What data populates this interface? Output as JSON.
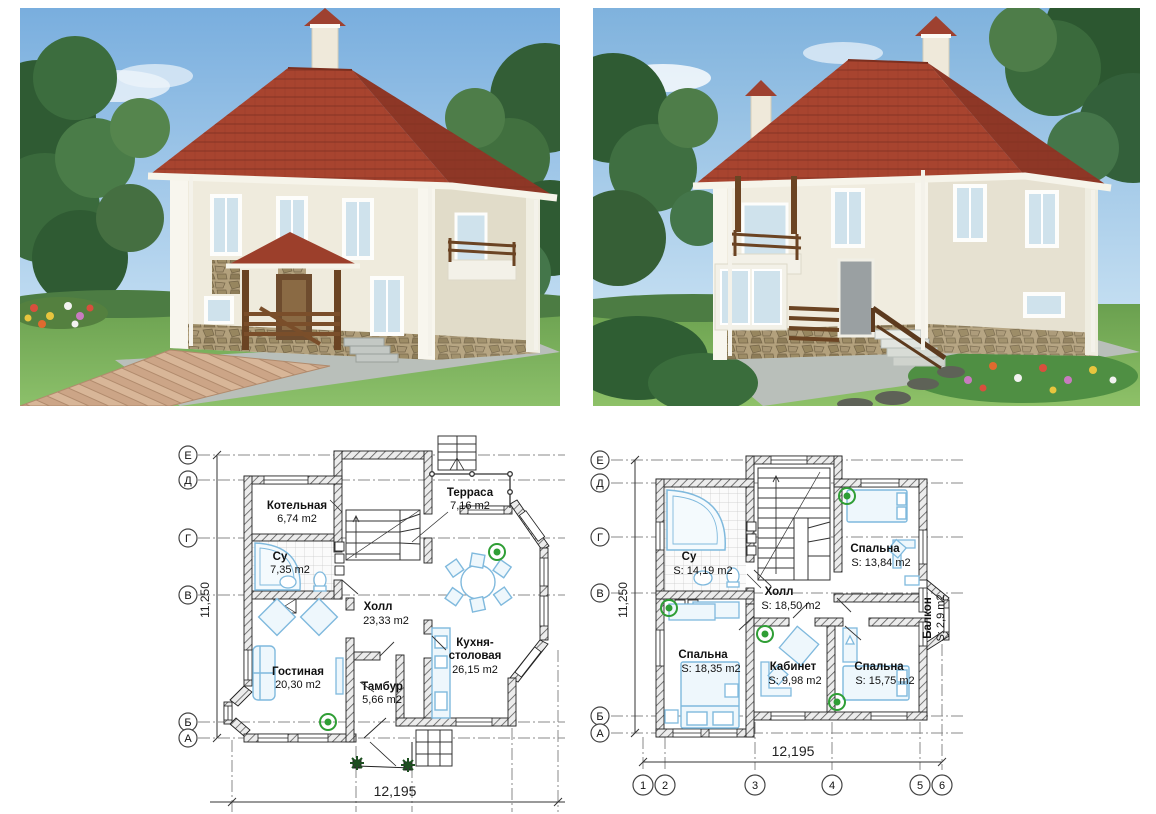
{
  "renders": [
    {
      "id": "front-view",
      "description": "front exterior render"
    },
    {
      "id": "rear-view",
      "description": "rear exterior render"
    }
  ],
  "colors": {
    "roof_red": "#9e4130",
    "wall_cream": "#efebdd",
    "sky_blue": "#85b5de",
    "lawn_green": "#74aa58",
    "plan_fixture_blue": "#7fb9dd",
    "plant_green": "#2f9e35",
    "wood_brown": "#6b4423",
    "stone_tan": "#a7946e"
  },
  "plans": [
    {
      "id": "first-floor",
      "dim_width": "12,195",
      "dim_height": "11,250",
      "row_axes": [
        "Е",
        "Д",
        "Г",
        "В",
        "Б",
        "А"
      ],
      "rooms": {
        "kotelnaya": {
          "name": "Котельная",
          "area": "6,74 m2"
        },
        "terrasa": {
          "name": "Терраса",
          "area": "7,16 m2"
        },
        "su": {
          "name": "Су",
          "area": "7,35 m2"
        },
        "holl": {
          "name": "Холл",
          "area": "23,33 m2"
        },
        "gostinaya": {
          "name": "Гостиная",
          "area": "20,30 m2"
        },
        "tambur": {
          "name": "Тамбур",
          "area": "5,66 m2"
        },
        "kuhnya": {
          "line1": "Кухня-",
          "line2": "столовая",
          "area": "26,15 m2"
        }
      }
    },
    {
      "id": "second-floor",
      "dim_width": "12,195",
      "dim_height": "11,250",
      "row_axes": [
        "Е",
        "Д",
        "Г",
        "В",
        "Б",
        "А"
      ],
      "col_axes": [
        "1",
        "2",
        "3",
        "4",
        "5",
        "6"
      ],
      "rooms": {
        "su": {
          "name": "Су",
          "area": "S: 14,19 m2"
        },
        "holl": {
          "name": "Холл",
          "area": "S: 18,50 m2"
        },
        "spalnya1": {
          "name": "Спальна",
          "area": "S: 13,84 m2"
        },
        "spalnya2": {
          "name": "Спальна",
          "area": "S: 18,35 m2"
        },
        "kabinet": {
          "name": "Кабинет",
          "area": "S: 9,98 m2"
        },
        "spalnya3": {
          "name": "Спальна",
          "area": "S: 15,75 m2"
        },
        "balkon": {
          "name": "Балкон",
          "area": "S: 2,9 m2"
        }
      }
    }
  ]
}
